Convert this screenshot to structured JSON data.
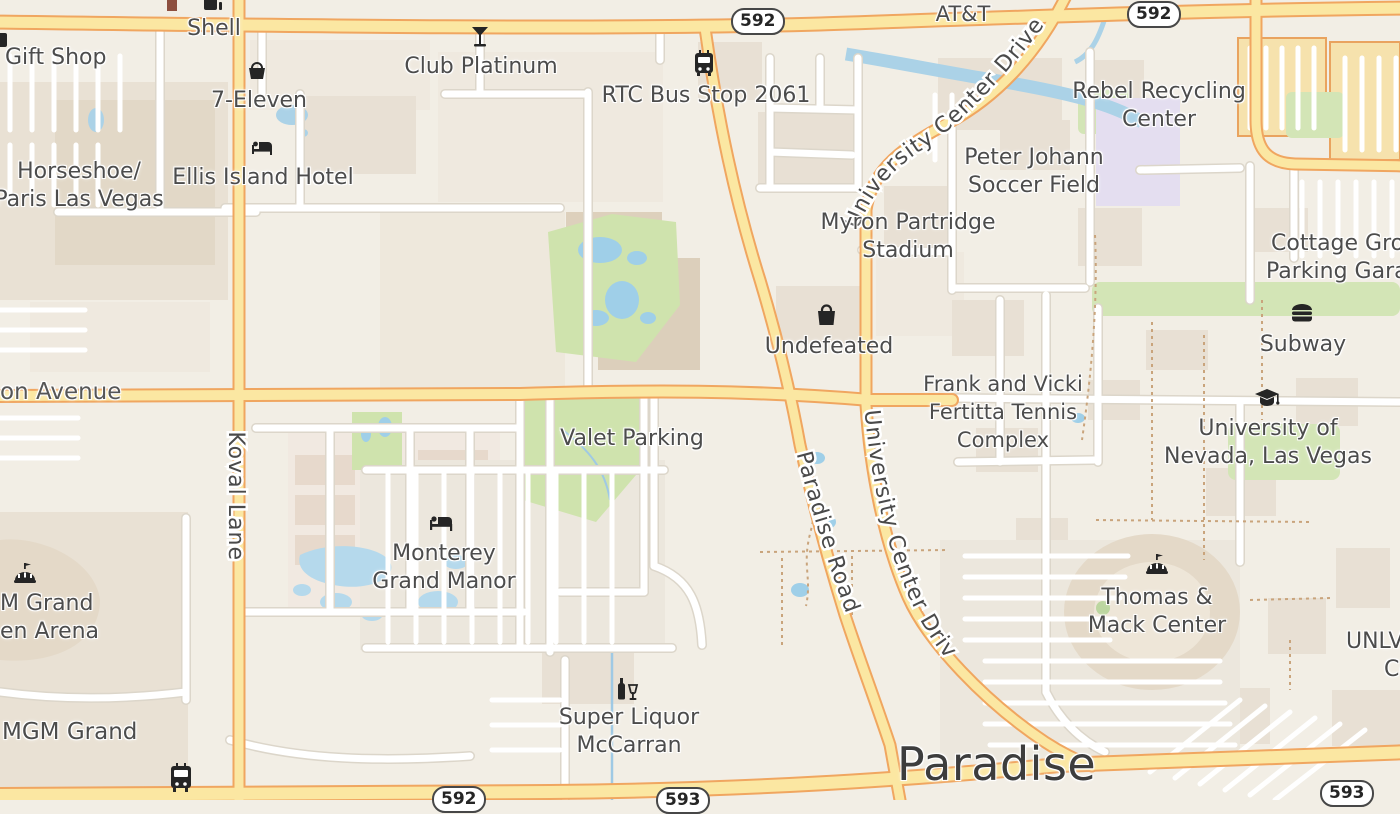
{
  "map": {
    "city_label": "Paradise",
    "route_badges": {
      "top_center": "592",
      "top_right": "592",
      "bottom_left": "592",
      "bottom_center": "593",
      "bottom_right": "593"
    },
    "road_labels": {
      "harmon_partial": "on Avenue",
      "koval": "Koval Lane",
      "paradise_road": "Paradise Road",
      "university_center_top": "University Center Drive",
      "university_center_mid": "University Center Drive"
    },
    "pois": {
      "gift_shop": "Gift Shop",
      "shell": "Shell",
      "seven_eleven": "7-Eleven",
      "horseshoe_1": "Horseshoe/",
      "horseshoe_2": "Paris Las Vegas",
      "ellis_island": "Ellis Island Hotel",
      "club_platinum": "Club Platinum",
      "rtc_bus_stop": "RTC Bus Stop 2061",
      "att": "AT&T",
      "rebel_1": "Rebel Recycling",
      "rebel_2": "Center",
      "peter_1": "Peter Johann",
      "peter_2": "Soccer Field",
      "myron_1": "Myron Partridge",
      "myron_2": "Stadium",
      "cottage_1": "Cottage Grove",
      "cottage_2": "Parking Garage",
      "undefeated": "Undefeated",
      "frank_1": "Frank and Vicki",
      "frank_2": "Fertitta Tennis",
      "frank_3": "Complex",
      "subway": "Subway",
      "unlv_1": "University of",
      "unlv_2": "Nevada, Las Vegas",
      "valet_parking": "Valet Parking",
      "monterey_1": "Monterey",
      "monterey_2": "Grand Manor",
      "mgm_arena_1": "M Grand",
      "mgm_arena_2": "en Arena",
      "mgm_grand": "MGM Grand",
      "super_1": "Super Liquor",
      "super_2": "McCarran",
      "thomas_1": "Thomas &",
      "thomas_2": "Mack Center",
      "unlv_ce_1": "UNLV",
      "unlv_ce_2": "Ce"
    },
    "icons": {
      "shell": "fuel-icon",
      "seven_eleven": "basket-icon",
      "ellis_island": "bed-icon",
      "club_platinum": "cocktail-icon",
      "rtc_bus_stop": "bus-icon",
      "undefeated": "shopping-bag-icon",
      "monterey": "bed-icon",
      "super_liquor": "liquor-icon",
      "mgm_arena": "arena-icon",
      "thomas_mack": "arena-icon",
      "subway": "burger-icon",
      "unlv": "graduation-cap-icon",
      "bottom_bus": "bus-icon"
    },
    "colors": {
      "background": "#f2eee5",
      "road_minor": "#ffffff",
      "road_minor_casing": "#dcd6ca",
      "road_major_fill": "#fbe7a2",
      "road_major_casing": "#f0a660",
      "water": "#abd2e7",
      "park": "#cfe3ad",
      "campus_purple": "#e4def0",
      "building": "#e8e0d4",
      "parking_garage": "#f6e2ad",
      "label_text": "#4c4c4c"
    }
  }
}
